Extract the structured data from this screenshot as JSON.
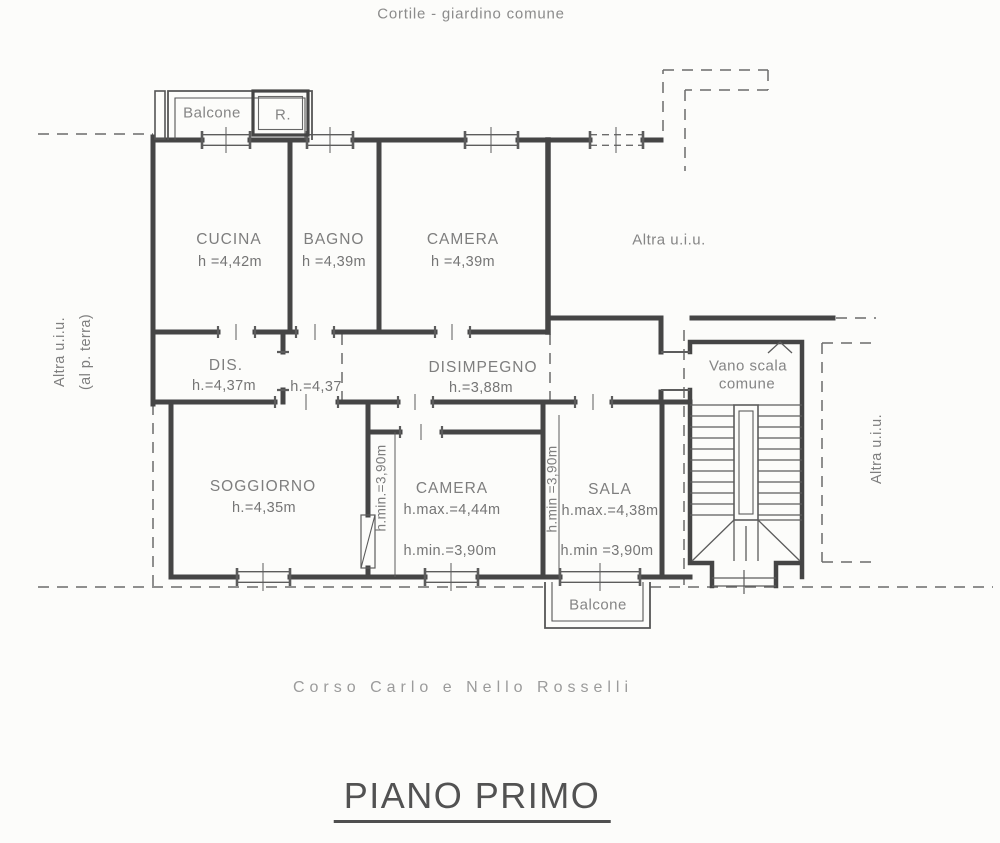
{
  "header": {
    "courtyard_label": "Cortile - giardino comune"
  },
  "footer": {
    "street_label": "Corso Carlo e Nello Rosselli",
    "title": "PIANO PRIMO"
  },
  "plan": {
    "balcony_top": "Balcone",
    "balcony_bottom": "Balcone",
    "r_box": "R.",
    "stairwell_line1": "Vano scala",
    "stairwell_line2": "comune",
    "adjacent_left_line1": "Altra u.i.u.",
    "adjacent_left_line2": "(al p. terra)",
    "adjacent_right": "Altra u.i.u.",
    "adjacent_top": "Altra u.i.u.",
    "rooms": {
      "cucina": {
        "name": "CUCINA",
        "h": "h =4,42m"
      },
      "bagno": {
        "name": "BAGNO",
        "h": "h =4,39m"
      },
      "camera_nord": {
        "name": "CAMERA",
        "h": "h =4,39m"
      },
      "dis": {
        "name": "DIS.",
        "h": "h.=4,37m"
      },
      "vestibolo": {
        "h": "h.=4,37"
      },
      "disimpegno": {
        "name": "DISIMPEGNO",
        "h": "h.=3,88m"
      },
      "soggiorno": {
        "name": "SOGGIORNO",
        "h": "h.=4,35m"
      },
      "camera_sud": {
        "name": "CAMERA",
        "h_max": "h.max.=4,44m",
        "h_min": "h.min.=3,90m",
        "h_min_side": "h.min.=3,90m"
      },
      "sala": {
        "name": "SALA",
        "h_max": "h.max.=4,38m",
        "h_min": "h.min =3,90m",
        "h_min_side": "h.min =3,90m"
      }
    }
  },
  "colors": {
    "wall": "#454545",
    "thin_line": "#5c5c5c",
    "dashed_line": "#6b6b6b",
    "label_text": "#7e7e7e",
    "title_text": "#525252",
    "background": "#fcfcfa"
  }
}
